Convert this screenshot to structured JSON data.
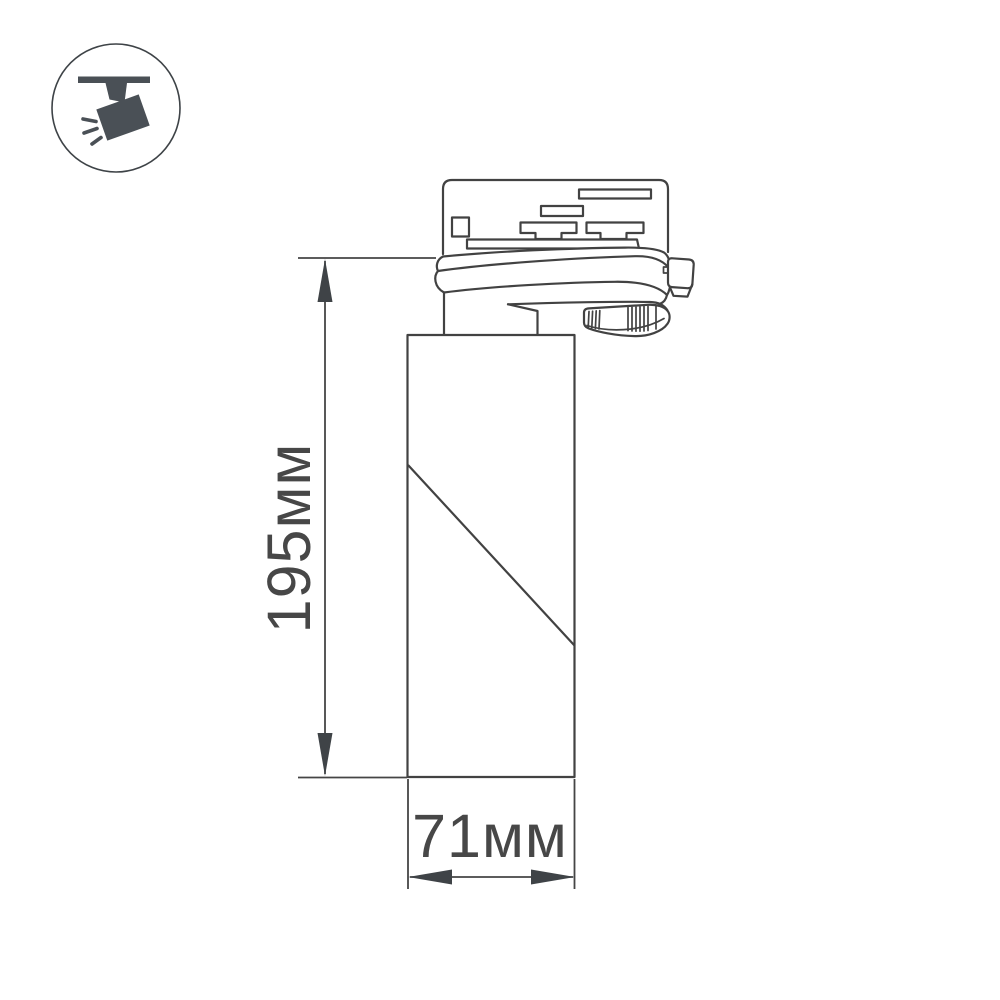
{
  "colors": {
    "background": "#ffffff",
    "drawing_line": "#424242",
    "dimension_text": "#474747",
    "icon_glyph": "#4a5056",
    "icon_circle_stroke": "#3e4347"
  },
  "icon_badge": {
    "name": "ceiling-track-spotlight-icon"
  },
  "diagram": {
    "type": "product-dimension-drawing",
    "subject": "cylindrical track-mounted spotlight, side view",
    "height_dimension": {
      "label": "195мм",
      "value": 195,
      "unit": "мм",
      "orientation": "vertical"
    },
    "width_dimension": {
      "label": "71мм",
      "value": 71,
      "unit": "мм",
      "orientation": "horizontal"
    }
  }
}
